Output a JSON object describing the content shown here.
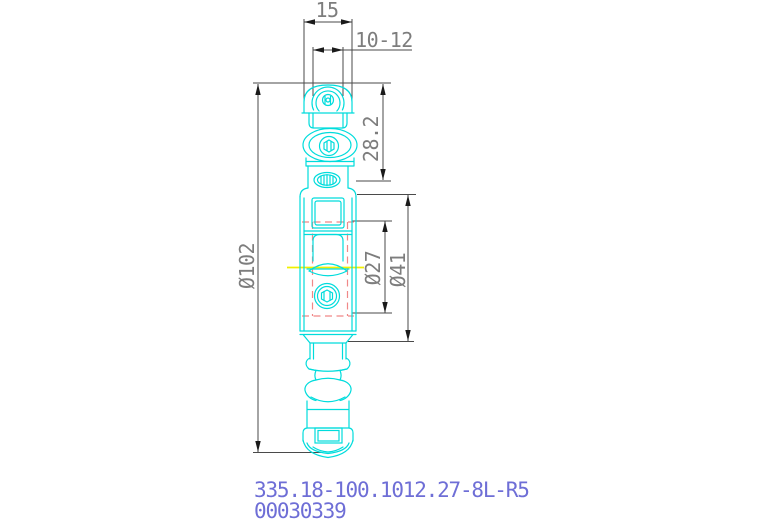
{
  "drawing": {
    "dimensions": {
      "top_width": "15",
      "slot_width": "10-12",
      "roller_section_height": "28.2",
      "overall_length": "Ø102",
      "inner_diameter": "Ø27",
      "body_diameter": "Ø41"
    },
    "title_block": {
      "part_number": "335.18-100.1012.27-8L-R5",
      "drawing_number": "00030339"
    },
    "colors": {
      "part_line": "#00dcdc",
      "hidden_line": "#f08888",
      "centerline": "#f0f000",
      "dimension_line": "#4a4a4a",
      "arrow": "#1a1a1a",
      "dimension_text": "#7d7d7d",
      "label_text": "#6e6ed6",
      "background": "#ffffff"
    }
  }
}
